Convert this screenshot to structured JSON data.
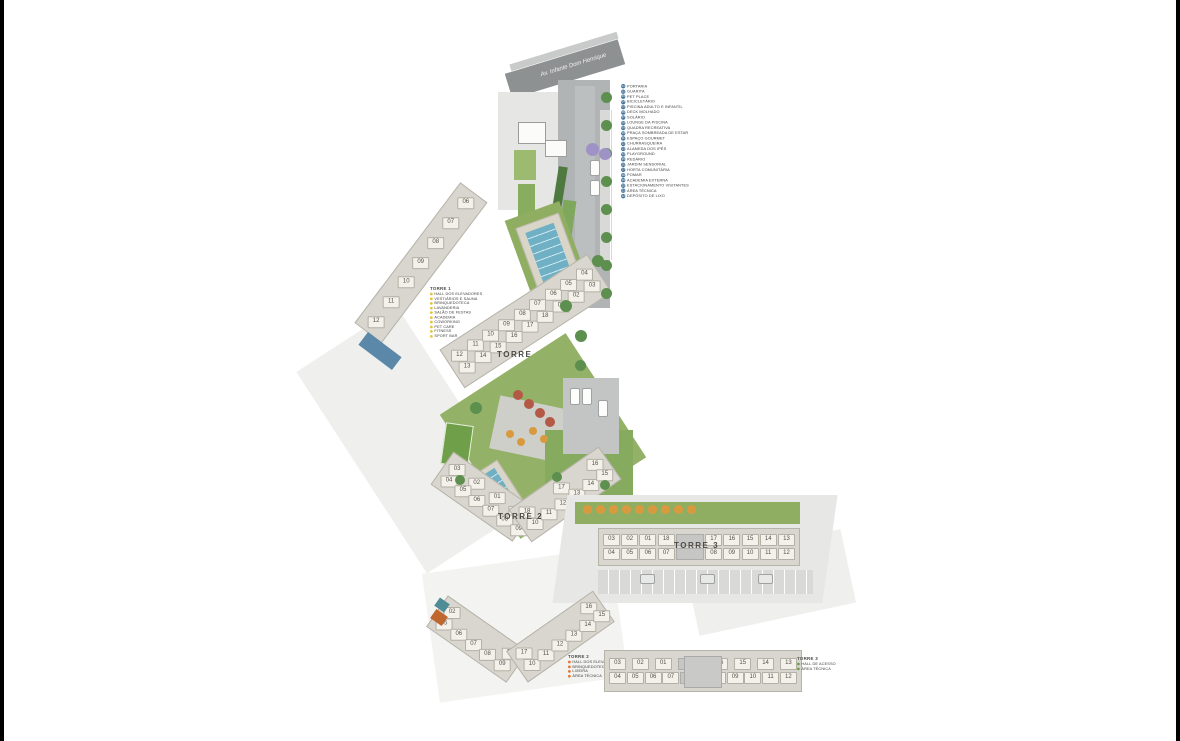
{
  "page": {
    "background": "#ffffff",
    "frame_color": "#000000"
  },
  "colors": {
    "legend_marker_blue": "#44759d",
    "bullet_yellow": "#e6c33c",
    "bullet_orange": "#e2762d",
    "bullet_green": "#6fa04a",
    "pool_blue": "#6fb0c4",
    "lawn_green": "#93b267",
    "road_gray": "#8e9192",
    "building_cream": "#f3f1e9",
    "tree_orange": "#d99a3f",
    "tree_red": "#b35945",
    "tree_purple": "#9e92c6",
    "tree_green": "#5d8f4e"
  },
  "site_plan": {
    "street_name": "Av. Infante Dom Henrique",
    "main_legend": {
      "items": [
        {
          "num": "01",
          "label": "PORTARIA"
        },
        {
          "num": "02",
          "label": "GUARITA"
        },
        {
          "num": "03",
          "label": "PET PLACE"
        },
        {
          "num": "04",
          "label": "BICICLETÁRIO"
        },
        {
          "num": "05",
          "label": "PISCINA ADULTO E INFANTIL"
        },
        {
          "num": "06",
          "label": "DECK MOLHADO"
        },
        {
          "num": "07",
          "label": "SOLÁRIO"
        },
        {
          "num": "08",
          "label": "LOUNGE DA PISCINA"
        },
        {
          "num": "09",
          "label": "QUADRA RECREATIVA"
        },
        {
          "num": "10",
          "label": "PRAÇA SOMBREADA DE ESTAR"
        },
        {
          "num": "11",
          "label": "ESPAÇO GOURMET"
        },
        {
          "num": "12",
          "label": "CHURRASQUEIRA"
        },
        {
          "num": "13",
          "label": "ALAMEDA DOS IPÊS"
        },
        {
          "num": "14",
          "label": "PLAYGROUND"
        },
        {
          "num": "15",
          "label": "REDÁRIO"
        },
        {
          "num": "16",
          "label": "JARDIM SENSORIAL"
        },
        {
          "num": "17",
          "label": "HORTA COMUNITÁRIA"
        },
        {
          "num": "18",
          "label": "POMAR"
        },
        {
          "num": "19",
          "label": "ACADEMIA EXTERNA"
        },
        {
          "num": "20",
          "label": "ESTACIONAMENTO VISITANTES"
        },
        {
          "num": "21",
          "label": "ÁREA TÉCNICA"
        },
        {
          "num": "22",
          "label": "DEPÓSITO DE LIXO"
        }
      ]
    },
    "towers": {
      "torre1": {
        "label": "TORRE 1",
        "rows": [
          [
            "12",
            "11",
            "10",
            "09",
            "08",
            "07",
            "06",
            "05",
            "04"
          ],
          [
            "13",
            "14",
            "15",
            "16",
            "17",
            "18",
            "01",
            "02",
            "03"
          ]
        ]
      },
      "torre2": {
        "label": "TORRE 2",
        "left_rows": [
          [
            "03",
            "02",
            "01",
            "19"
          ],
          [
            "04",
            "05",
            "06",
            "07",
            "08",
            "09"
          ]
        ],
        "right_rows": [
          [
            "18",
            "17",
            "16"
          ],
          [
            "10",
            "11",
            "12",
            "13",
            "14",
            "15"
          ]
        ]
      },
      "torre3": {
        "label": "TORRE 3",
        "rows": [
          [
            "03",
            "02",
            "01",
            "18",
            null,
            "17",
            "16",
            "15",
            "14",
            "13"
          ],
          [
            "04",
            "05",
            "06",
            "07",
            null,
            "08",
            "09",
            "10",
            "11",
            "12"
          ]
        ]
      }
    }
  },
  "floor_plans": {
    "torre1": {
      "rows": [
        [
          "12",
          "11",
          "10",
          "09",
          "08",
          "07",
          "06"
        ]
      ],
      "legend": {
        "title": "TORRE 1",
        "bullet": "#e6c33c",
        "items": [
          "HALL DOS ELEVADORES",
          "VESTIÁRIOS E SAUNA",
          "BRINQUEDOTECA",
          "LAVANDERIA",
          "SALÃO DE FESTAS",
          "ACADEMIA",
          "COWORKING",
          "PET CARE",
          "FITNESS",
          "SPORT BAR"
        ]
      }
    },
    "torre2": {
      "left_rows": [
        [
          "02",
          "01"
        ],
        [
          "05",
          "06",
          "07",
          "08",
          "09"
        ]
      ],
      "right_rows": [
        [
          "17",
          "16"
        ],
        [
          "10",
          "11",
          "12",
          "13",
          "14",
          "15"
        ]
      ],
      "legend": {
        "title": "TORRE 2",
        "bullet": "#e2762d",
        "items": [
          "HALL DOS ELEVADORES",
          "BRINQUEDOTECA",
          "LIXEIRA",
          "ÁREA TÉCNICA"
        ]
      }
    },
    "torre3": {
      "rows": [
        [
          "03",
          "02",
          "01",
          null,
          "16",
          "15",
          "14",
          "13"
        ],
        [
          "04",
          "05",
          "06",
          "07",
          null,
          "08",
          "09",
          "10",
          "11",
          "12"
        ]
      ],
      "legend": {
        "title": "TORRE 3",
        "bullet": "#6fa04a",
        "items": [
          "HALL DE ACESSO",
          "ÁREA TÉCNICA"
        ]
      }
    }
  }
}
